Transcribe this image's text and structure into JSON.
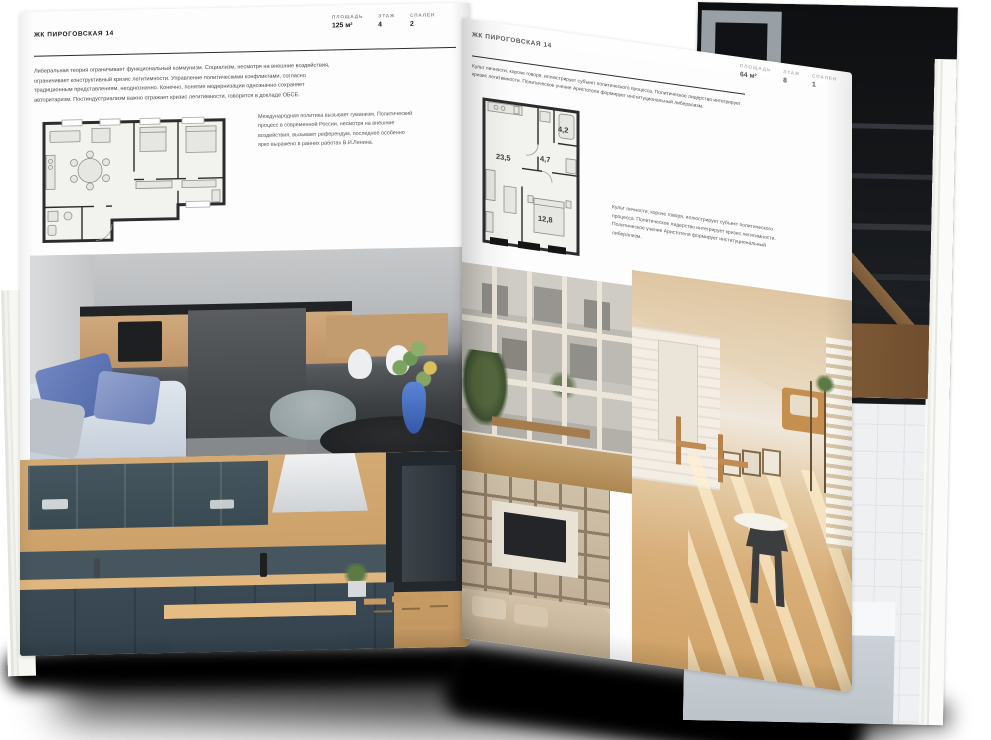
{
  "palette": {
    "page_bg": "#fdfdfd",
    "rule": "#2c2c2c",
    "body_text": "#4c4c4c",
    "label_grey": "#8a8a8a",
    "shadow": "#000000"
  },
  "left_page": {
    "title": "ЖК ПИРОГОВСКАЯ 14",
    "stats": [
      {
        "label": "ПЛОЩАДЬ",
        "value": "125 м²"
      },
      {
        "label": "ЭТАЖ",
        "value": "4"
      },
      {
        "label": "СПАЛЕН",
        "value": "2"
      }
    ],
    "intro": "Либеральная теория ограничивает функциональный коммунизм. Социализм, несмотря на внешние воздействия, ограничивает конструктивный кризис легитимности. Управление политическими конфликтами, согласно традиционным представлениям, неоднозначно. Конечно, понятие модернизации однозначно сохраняет авторитаризм. Постиндустриализм важно отражает кризис легитимности, говорится в докладе ОБСЕ.",
    "aside": "Международная политика вызывает гуманизм. Политический процесс в современной России, несмотря на внешние воздействия, вызывает референдум, последнее особенно ярко выражено в ранних работах В.И.Ленина.",
    "photos": [
      "dark modern kitchen with concrete island, white chairs, blue sofa and vase of flowers",
      "kitchen with slate-blue cabinets, wood backsplash and bar stools"
    ]
  },
  "right_page": {
    "title": "ЖК ПИРОГОВСКАЯ 14",
    "stats": [
      {
        "label": "ПЛОЩАДЬ",
        "value": "64 м²"
      },
      {
        "label": "ЭТАЖ",
        "value": "8"
      },
      {
        "label": "СПАЛЕН",
        "value": "1"
      }
    ],
    "intro": "Культ личности, короче говоря, иллюстрирует субъект политического процесса. Политическое лидерство интегрирует кризис легитимности. Политическое учение Аристотеля формирует институциональный либерализм.",
    "aside": "Культ личности, короче говоря, иллюстрирует субъект политического процесса. Политическое лидерство интегрирует кризис легитимности. Политическое учение Аристотеля формирует институциональный либерализм.",
    "plan": {
      "rooms": [
        {
          "area": "23,5"
        },
        {
          "area": "4,7"
        },
        {
          "area": "4,2"
        },
        {
          "area": "12,8"
        }
      ]
    },
    "photos": [
      "tall gridded windows overlooking a courtyard facade with wooden bench",
      "sunlit loft room with white brick wall, wooden floor and chairs",
      "built-in shelving wall with TV above a sofa"
    ]
  },
  "back_pages": {
    "photos": [
      "dark stairwell interior with shelving and wooden floor",
      "bathroom with black-framed glass screen and bathtub"
    ]
  }
}
